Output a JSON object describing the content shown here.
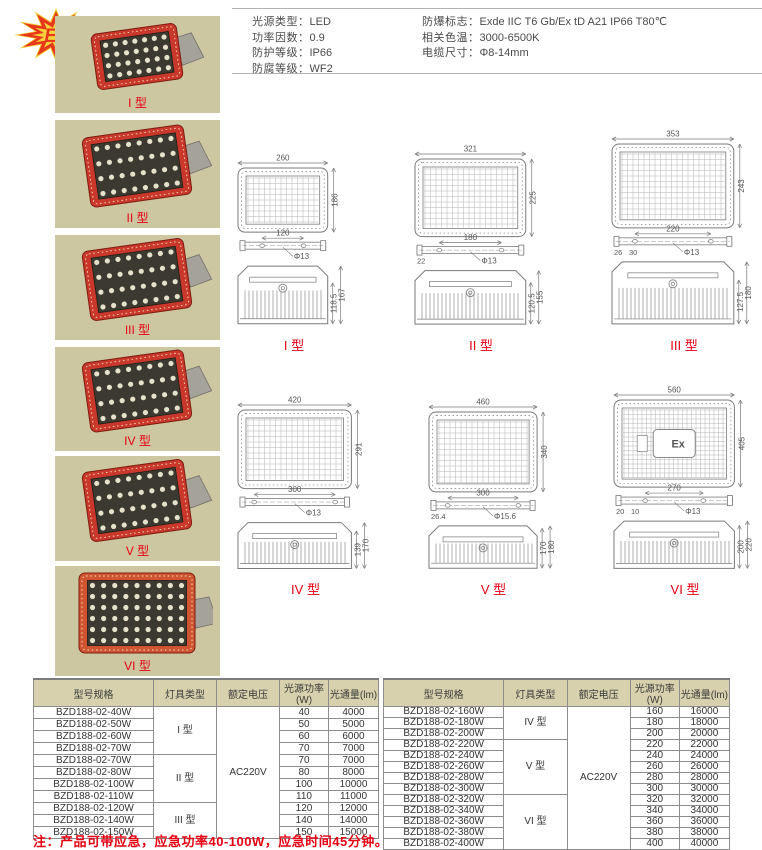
{
  "badge": {
    "text": "Ex"
  },
  "new_tag": "新款",
  "specs": {
    "left": [
      {
        "label": "光源类型：",
        "value": "LED"
      },
      {
        "label": "功率因数：",
        "value": "0.9"
      },
      {
        "label": "防护等级：",
        "value": "IP66"
      },
      {
        "label": "防腐等级：",
        "value": "WF2"
      }
    ],
    "right": [
      {
        "label": "防爆标志：",
        "value": "Exde IIC T6 Gb/Ex tD A21 IP66 T80℃"
      },
      {
        "label": "相关色温：",
        "value": "3000-6500K"
      },
      {
        "label": "电缆尺寸：",
        "value": "Φ8-14mm"
      }
    ]
  },
  "photos": [
    {
      "label": "I 型"
    },
    {
      "label": "II 型"
    },
    {
      "label": "III 型"
    },
    {
      "label": "IV 型"
    },
    {
      "label": "V 型"
    },
    {
      "label": "VI 型"
    }
  ],
  "drawings": [
    {
      "label": "I 型",
      "front_width": "260",
      "front_height": "186",
      "bracket_span": "120",
      "hole": "Φ13",
      "side_inner": "118.5",
      "side_outer": "167",
      "extras": []
    },
    {
      "label": "II 型",
      "front_width": "321",
      "front_height": "225",
      "bracket_span": "180",
      "hole": "Φ13",
      "side_inner": "120.5",
      "side_outer": "155",
      "extras": [
        "22"
      ]
    },
    {
      "label": "III 型",
      "front_width": "353",
      "front_height": "243",
      "bracket_span": "220",
      "hole": "Φ13",
      "side_inner": "127.5",
      "side_outer": "180",
      "extras": [
        "26",
        "30"
      ]
    },
    {
      "label": "IV 型",
      "front_width": "420",
      "front_height": "291",
      "bracket_span": "300",
      "hole": "Φ13",
      "side_inner": "139",
      "side_outer": "170",
      "extras": []
    },
    {
      "label": "V 型",
      "front_width": "460",
      "front_height": "340",
      "bracket_span": "300",
      "hole": "Φ15.6",
      "side_inner": "170",
      "side_outer": "180",
      "extras": [
        "26.4"
      ]
    },
    {
      "label": "VI 型",
      "front_width": "560",
      "front_height": "405",
      "bracket_span": "270",
      "hole": "Φ13",
      "side_inner": "200",
      "side_outer": "220",
      "extras": [
        "20",
        "10"
      ],
      "nameplate": "Ex"
    }
  ],
  "tables": [
    {
      "headers": [
        "型号规格",
        "灯具类型",
        "额定电压",
        "光源功率(W)",
        "光通量(lm)"
      ],
      "voltage": "AC220V",
      "groups": [
        {
          "type": "I 型",
          "rows": [
            [
              "BZD188-02-40W",
              "40",
              "4000"
            ],
            [
              "BZD188-02-50W",
              "50",
              "5000"
            ],
            [
              "BZD188-02-60W",
              "60",
              "6000"
            ],
            [
              "BZD188-02-70W",
              "70",
              "7000"
            ]
          ]
        },
        {
          "type": "II 型",
          "rows": [
            [
              "BZD188-02-70W",
              "70",
              "7000"
            ],
            [
              "BZD188-02-80W",
              "80",
              "8000"
            ],
            [
              "BZD188-02-100W",
              "100",
              "10000"
            ],
            [
              "BZD188-02-110W",
              "110",
              "11000"
            ]
          ]
        },
        {
          "type": "III 型",
          "rows": [
            [
              "BZD188-02-120W",
              "120",
              "12000"
            ],
            [
              "BZD188-02-140W",
              "140",
              "14000"
            ],
            [
              "BZD188-02-150W",
              "150",
              "15000"
            ]
          ]
        }
      ]
    },
    {
      "headers": [
        "型号规格",
        "灯具类型",
        "额定电压",
        "光源功率(W)",
        "光通量(lm)"
      ],
      "voltage": "AC220V",
      "groups": [
        {
          "type": "IV 型",
          "rows": [
            [
              "BZD188-02-160W",
              "160",
              "16000"
            ],
            [
              "BZD188-02-180W",
              "180",
              "18000"
            ],
            [
              "BZD188-02-200W",
              "200",
              "20000"
            ]
          ]
        },
        {
          "type": "V 型",
          "rows": [
            [
              "BZD188-02-220W",
              "220",
              "22000"
            ],
            [
              "BZD188-02-240W",
              "240",
              "24000"
            ],
            [
              "BZD188-02-260W",
              "260",
              "26000"
            ],
            [
              "BZD188-02-280W",
              "280",
              "28000"
            ],
            [
              "BZD188-02-300W",
              "300",
              "30000"
            ]
          ]
        },
        {
          "type": "VI 型",
          "rows": [
            [
              "BZD188-02-320W",
              "320",
              "32000"
            ],
            [
              "BZD188-02-340W",
              "340",
              "34000"
            ],
            [
              "BZD188-02-360W",
              "360",
              "36000"
            ],
            [
              "BZD188-02-380W",
              "380",
              "38000"
            ],
            [
              "BZD188-02-400W",
              "400",
              "40000"
            ]
          ]
        }
      ]
    }
  ],
  "note": "注：产品可带应急，应急功率40-100W，应急时间45分钟。",
  "colors": {
    "accent_red": "#e60012",
    "panel_khaki": "#cdc7a1",
    "header_khaki": "#d7d2ad",
    "lamp_frame_red": "#c9382a",
    "lamp_frame_orange": "#d05430"
  }
}
